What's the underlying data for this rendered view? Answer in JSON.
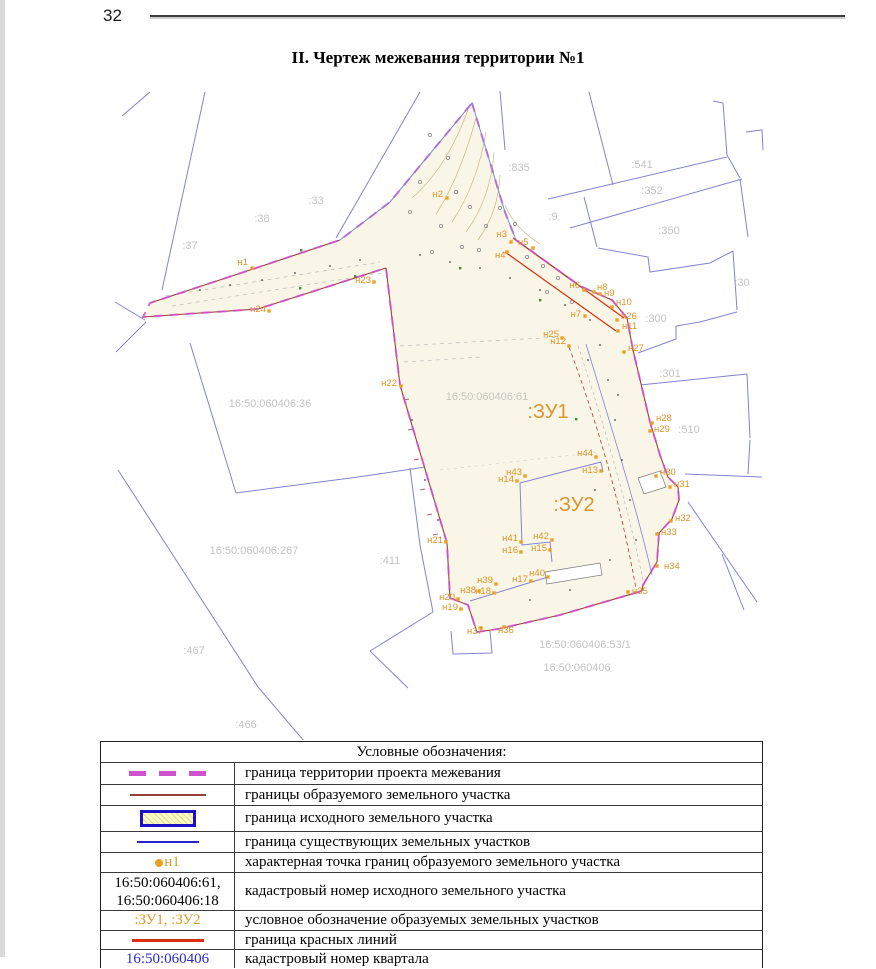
{
  "page": {
    "number": "32",
    "title": "II. Чертеж межевания территории №1"
  },
  "colors": {
    "project_boundary_magenta": "#cf52cf",
    "formed_parcel_dark_red": "#9a4038",
    "source_parcel_blue": "#1c10c8",
    "existing_parcel_blue": "#8383d2",
    "point_orange": "#e09a2e",
    "red_lines": "#d93011",
    "quarter_number_blue": "#2a2ad4",
    "gray_label": "#c3c3c3",
    "parcel_fill_cream": "#faf6e7"
  },
  "map": {
    "zu_labels": [
      {
        "text": ":ЗУ1",
        "x": 548,
        "y": 418
      },
      {
        "text": ":ЗУ2",
        "x": 574,
        "y": 511
      }
    ],
    "cadastral_labels": [
      {
        "text": ":37",
        "x": 190,
        "y": 249
      },
      {
        "text": ":38",
        "x": 262,
        "y": 222
      },
      {
        "text": ":33",
        "x": 316,
        "y": 204
      },
      {
        "text": ":835",
        "x": 519,
        "y": 171
      },
      {
        "text": ":541",
        "x": 642,
        "y": 168
      },
      {
        "text": ":352",
        "x": 652,
        "y": 194
      },
      {
        "text": ":350",
        "x": 669,
        "y": 234
      },
      {
        "text": ":9",
        "x": 553,
        "y": 220
      },
      {
        "text": ":30",
        "x": 742,
        "y": 286
      },
      {
        "text": ":300",
        "x": 656,
        "y": 322
      },
      {
        "text": ":301",
        "x": 670,
        "y": 377
      },
      {
        "text": ":510",
        "x": 689,
        "y": 433
      },
      {
        "text": "16:50:060406:36",
        "x": 270,
        "y": 407
      },
      {
        "text": "16:50:060406:61",
        "x": 487,
        "y": 400
      },
      {
        "text": "16:50:060406:267",
        "x": 254,
        "y": 554
      },
      {
        "text": ":411",
        "x": 390,
        "y": 564
      },
      {
        "text": ":467",
        "x": 194,
        "y": 654
      },
      {
        "text": ":466",
        "x": 246,
        "y": 728
      },
      {
        "text": "16:50:060406:53/1",
        "x": 585,
        "y": 648
      },
      {
        "text": "16:50:060406",
        "x": 577,
        "y": 671
      }
    ],
    "points": [
      {
        "label": "н1",
        "x": 252,
        "y": 268,
        "lx": 248,
        "ly": 265,
        "a": "end"
      },
      {
        "label": "н2",
        "x": 447,
        "y": 198,
        "lx": 443,
        "ly": 197,
        "a": "end"
      },
      {
        "label": "н3",
        "x": 511,
        "y": 242,
        "lx": 507,
        "ly": 237,
        "a": "end"
      },
      {
        "label": "н4",
        "x": 507,
        "y": 252,
        "lx": 495,
        "ly": 258,
        "a": "start"
      },
      {
        "label": "н5",
        "x": 533,
        "y": 248,
        "lx": 518,
        "ly": 245,
        "a": "start"
      },
      {
        "label": "н6",
        "x": 584,
        "y": 290,
        "lx": 580,
        "ly": 288,
        "a": "end"
      },
      {
        "label": "н7",
        "x": 585,
        "y": 316,
        "lx": 581,
        "ly": 317,
        "a": "end"
      },
      {
        "label": "н8",
        "x": 594,
        "y": 292,
        "lx": 597,
        "ly": 290,
        "a": "start"
      },
      {
        "label": "н9",
        "x": 600,
        "y": 294,
        "lx": 604,
        "ly": 296,
        "a": "start"
      },
      {
        "label": "н10",
        "x": 612,
        "y": 307,
        "lx": 616,
        "ly": 305,
        "a": "start"
      },
      {
        "label": "н11",
        "x": 618,
        "y": 331,
        "lx": 622,
        "ly": 329,
        "a": "start"
      },
      {
        "label": "н12",
        "x": 569,
        "y": 346,
        "lx": 566,
        "ly": 344,
        "a": "end"
      },
      {
        "label": "н13",
        "x": 601,
        "y": 471,
        "lx": 598,
        "ly": 473,
        "a": "end"
      },
      {
        "label": "н14",
        "x": 517,
        "y": 481,
        "lx": 514,
        "ly": 482,
        "a": "end"
      },
      {
        "label": "н15",
        "x": 550,
        "y": 550,
        "lx": 547,
        "ly": 551,
        "a": "end"
      },
      {
        "label": "н16",
        "x": 521,
        "y": 552,
        "lx": 518,
        "ly": 553,
        "a": "end"
      },
      {
        "label": "н17",
        "x": 531,
        "y": 581,
        "lx": 528,
        "ly": 582,
        "a": "end"
      },
      {
        "label": "н18",
        "x": 494,
        "y": 593,
        "lx": 491,
        "ly": 594,
        "a": "end"
      },
      {
        "label": "н19",
        "x": 461,
        "y": 609,
        "lx": 458,
        "ly": 610,
        "a": "end"
      },
      {
        "label": "н20",
        "x": 458,
        "y": 599,
        "lx": 455,
        "ly": 600,
        "a": "end"
      },
      {
        "label": "н21",
        "x": 446,
        "y": 542,
        "lx": 443,
        "ly": 543,
        "a": "end"
      },
      {
        "label": "н22",
        "x": 401,
        "y": 386,
        "lx": 397,
        "ly": 386,
        "a": "end"
      },
      {
        "label": "н23",
        "x": 374,
        "y": 282,
        "lx": 371,
        "ly": 283,
        "a": "end"
      },
      {
        "label": "н24",
        "x": 269,
        "y": 311,
        "lx": 266,
        "ly": 312,
        "a": "end"
      },
      {
        "label": "н25",
        "x": 562,
        "y": 338,
        "lx": 559,
        "ly": 337,
        "a": "end"
      },
      {
        "label": "н26",
        "x": 617,
        "y": 320,
        "lx": 621,
        "ly": 319,
        "a": "start"
      },
      {
        "label": "н27",
        "x": 624,
        "y": 352,
        "lx": 628,
        "ly": 351,
        "a": "start"
      },
      {
        "label": "н28",
        "x": 652,
        "y": 423,
        "lx": 656,
        "ly": 421,
        "a": "start"
      },
      {
        "label": "н29",
        "x": 650,
        "y": 431,
        "lx": 654,
        "ly": 432,
        "a": "start"
      },
      {
        "label": "н30",
        "x": 656,
        "y": 476,
        "lx": 660,
        "ly": 475,
        "a": "start"
      },
      {
        "label": "н31",
        "x": 670,
        "y": 487,
        "lx": 674,
        "ly": 487,
        "a": "start"
      },
      {
        "label": "н32",
        "x": 671,
        "y": 521,
        "lx": 675,
        "ly": 521,
        "a": "start"
      },
      {
        "label": "н33",
        "x": 657,
        "y": 534,
        "lx": 661,
        "ly": 535,
        "a": "start"
      },
      {
        "label": "н34",
        "x": 657,
        "y": 566,
        "lx": 664,
        "ly": 569,
        "a": "start"
      },
      {
        "label": "н35",
        "x": 628,
        "y": 592,
        "lx": 632,
        "ly": 594,
        "a": "start"
      },
      {
        "label": "н36",
        "x": 504,
        "y": 627,
        "lx": 498,
        "ly": 633,
        "a": "start"
      },
      {
        "label": "н37",
        "x": 481,
        "y": 628,
        "lx": 467,
        "ly": 634,
        "a": "start"
      },
      {
        "label": "н38",
        "x": 479,
        "y": 591,
        "lx": 476,
        "ly": 593,
        "a": "end"
      },
      {
        "label": "н39",
        "x": 496,
        "y": 584,
        "lx": 493,
        "ly": 583,
        "a": "end"
      },
      {
        "label": "н40",
        "x": 548,
        "y": 577,
        "lx": 545,
        "ly": 576,
        "a": "end"
      },
      {
        "label": "н41",
        "x": 521,
        "y": 542,
        "lx": 518,
        "ly": 541,
        "a": "end"
      },
      {
        "label": "н42",
        "x": 552,
        "y": 540,
        "lx": 549,
        "ly": 539,
        "a": "end"
      },
      {
        "label": "н43",
        "x": 525,
        "y": 476,
        "lx": 522,
        "ly": 475,
        "a": "end"
      },
      {
        "label": "н44",
        "x": 596,
        "y": 457,
        "lx": 593,
        "ly": 456,
        "a": "end"
      }
    ]
  },
  "legend": {
    "title": "Условные обозначения:",
    "rows": [
      {
        "label": "граница территории проекта межевания"
      },
      {
        "label": "границы образуемого земельного участка"
      },
      {
        "label": "граница исходного земельного участка"
      },
      {
        "label": "граница существующих земельных участков"
      },
      {
        "symbol_text": "н1",
        "label": "характерная точка границ образуемого земельного участка"
      },
      {
        "symbol_text_line1": "16:50:060406:61,",
        "symbol_text_line2": "16:50:060406:18",
        "label": "кадастровый номер исходного земельного участка"
      },
      {
        "symbol_text": ":ЗУ1, :ЗУ2",
        "label": "условное обозначение образуемых земельных участков"
      },
      {
        "label": "граница красных линий"
      },
      {
        "symbol_text": "16:50:060406",
        "label": "кадастровый номер квартала"
      }
    ]
  }
}
